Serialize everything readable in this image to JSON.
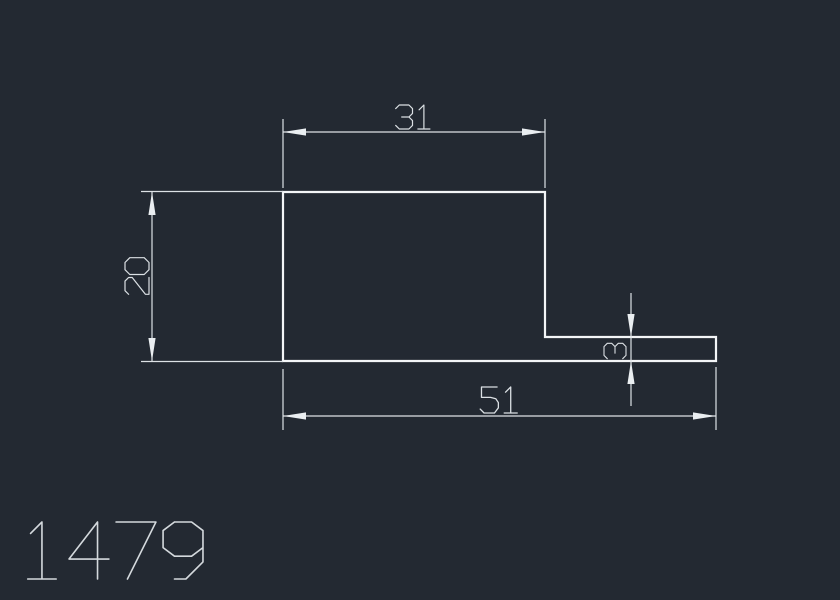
{
  "canvas": {
    "width": 840,
    "height": 600,
    "background_color": "#232932"
  },
  "style": {
    "shape_color": "#f3f5f7",
    "shape_stroke_width": 2.2,
    "dim_color": "#dde2e6",
    "dim_stroke_width": 1.2,
    "arrow_color": "#eaeef1",
    "arrow_length": 23,
    "arrow_half_width": 3.6,
    "text_color": "#dbe0e4",
    "title_color": "#d4d9dd"
  },
  "profile": {
    "description": "L-shaped profile cross-section outline",
    "closed": true,
    "points": [
      [
        283,
        192
      ],
      [
        545,
        192
      ],
      [
        545,
        337
      ],
      [
        716,
        337
      ],
      [
        716,
        361
      ],
      [
        283,
        361
      ]
    ]
  },
  "dimensions": [
    {
      "id": "top-width",
      "label": "31",
      "lines": [
        [
          283,
          132,
          545,
          132
        ]
      ],
      "extensions": [
        [
          283,
          119,
          283,
          188
        ],
        [
          545,
          119,
          545,
          188
        ]
      ],
      "arrows": [
        {
          "x": 283,
          "y": 132,
          "dir": "left"
        },
        {
          "x": 545,
          "y": 132,
          "dir": "right"
        }
      ],
      "text": {
        "x": 414,
        "y": 129,
        "rotation": 0,
        "size": 24
      }
    },
    {
      "id": "left-height",
      "label": "20",
      "lines": [
        [
          152,
          192,
          152,
          361
        ]
      ],
      "extensions": [
        [
          141,
          191.5,
          283,
          191.5
        ],
        [
          141,
          361.5,
          283,
          361.5
        ]
      ],
      "arrows": [
        {
          "x": 152,
          "y": 192,
          "dir": "up"
        },
        {
          "x": 152,
          "y": 361,
          "dir": "down"
        }
      ],
      "text": {
        "x": 149,
        "y": 276,
        "rotation": -90,
        "size": 24
      }
    },
    {
      "id": "flange-thickness",
      "label": "3",
      "lines": [
        [
          631,
          293,
          631,
          406
        ]
      ],
      "extensions": [],
      "arrows": [
        {
          "x": 631,
          "y": 337,
          "dir": "down"
        },
        {
          "x": 631,
          "y": 361,
          "dir": "up"
        }
      ],
      "text": {
        "x": 626,
        "y": 351,
        "rotation": -90,
        "size": 22
      }
    },
    {
      "id": "bottom-width",
      "label": "51",
      "lines": [
        [
          283,
          416,
          716,
          416
        ]
      ],
      "extensions": [
        [
          283,
          369,
          283,
          430
        ],
        [
          716,
          367,
          716,
          430
        ]
      ],
      "arrows": [
        {
          "x": 283,
          "y": 416,
          "dir": "left"
        },
        {
          "x": 716,
          "y": 416,
          "dir": "right"
        }
      ],
      "text": {
        "x": 500,
        "y": 413,
        "rotation": 0,
        "size": 26
      }
    }
  ],
  "title_block": {
    "drawing_number": "1479",
    "x": 22,
    "baseline_y": 579,
    "size": 57
  }
}
